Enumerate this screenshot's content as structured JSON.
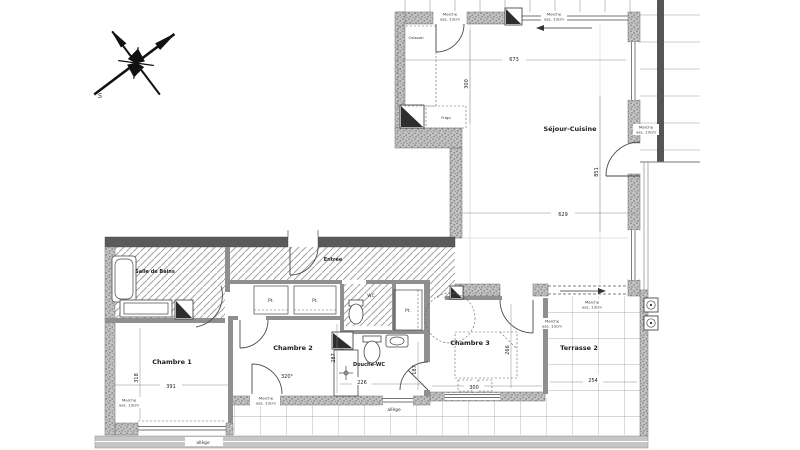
{
  "plan": {
    "compass": {
      "south_label": "S"
    },
    "rooms": {
      "sejour_cuisine": "Séjour-Cuisine",
      "entree": "Entrée",
      "salle_de_bains": "Salle de Bains",
      "wc": "WC",
      "chambre1": "Chambre 1",
      "chambre2": "Chambre 2",
      "chambre3": "Chambre 3",
      "douche_wc": "Douche-WC",
      "terrasse2": "Terrasse 2"
    },
    "fixtures": {
      "frigo": "Frigo",
      "caisson": "Caisson",
      "placard": "Pt.",
      "allege": "allège"
    },
    "annotations": {
      "step_line1": "Marche",
      "step_line2": "ass. 13cm",
      "door_angle": "320°"
    },
    "dimensions": {
      "sejour_width": "673",
      "kitchen_depth": "300",
      "sejour_length": "851",
      "sejour_south_width": "629",
      "chambre1_width": "391",
      "chambre1_depth": "318",
      "chambre2_depth": "287",
      "douche_width": "226",
      "douche_depth": "187",
      "chambre3_width": "300",
      "chambre3_depth": "266",
      "terrasse_width": "254"
    },
    "colors": {
      "wall_fill": "#c2c2c2",
      "wall_dark": "#5a5a5a",
      "hatch": "#a3a3a3",
      "line": "#4a4a4a"
    }
  }
}
